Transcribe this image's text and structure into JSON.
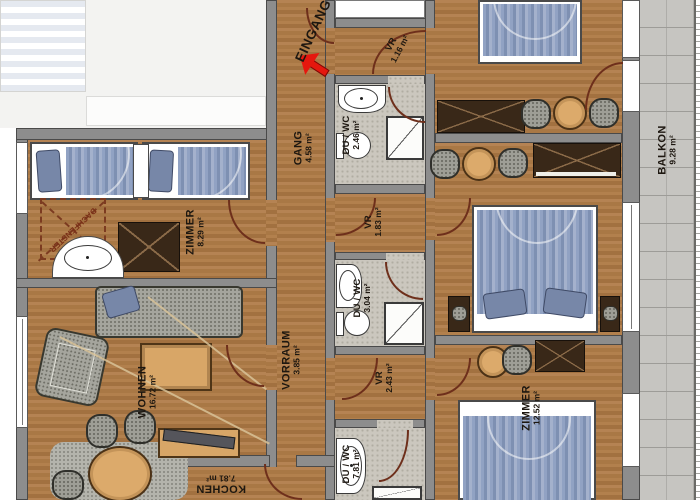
{
  "plan": {
    "type": "apartment-floor-plan",
    "entrance_label": "EINGANG",
    "roof_window_label": "DACHFENSTER"
  },
  "rooms": {
    "gang": {
      "name": "GANG",
      "area": "4.58 m²"
    },
    "vr_entry": {
      "name": "VR",
      "area": "1.16 m²"
    },
    "du_wc_top": {
      "name": "DU / WC",
      "area": "2.46 m²"
    },
    "zimmer_left": {
      "name": "ZIMMER",
      "area": "8.29 m²"
    },
    "vr_mid": {
      "name": "VR",
      "area": "1.83 m²"
    },
    "du_wc_mid": {
      "name": "DU / WC",
      "area": "3.04 m²"
    },
    "vorraum": {
      "name": "VORRAUM",
      "area": "3.85 m²"
    },
    "vr_low": {
      "name": "VR",
      "area": "2.43 m²"
    },
    "wohnen": {
      "name": "WOHNEN",
      "area": "16.72 m²"
    },
    "du_wc_low": {
      "name": "DU / WC",
      "area": "7.81 m²"
    },
    "kochen": {
      "name": "KOCHEN",
      "area": "7.81 m²"
    },
    "zimmer_rb": {
      "name": "ZIMMER",
      "area": "12.52 m²"
    },
    "balkon": {
      "name": "BALKON",
      "area": "9.28 m²"
    }
  },
  "colors": {
    "wood": "#ad7b48",
    "wall": "#8d8d8d",
    "tile": "#cbc7be",
    "bed_blue": "#8c9ec2",
    "door_arc": "#6e2f1b",
    "entry_arrow_red": "#e5170e"
  }
}
